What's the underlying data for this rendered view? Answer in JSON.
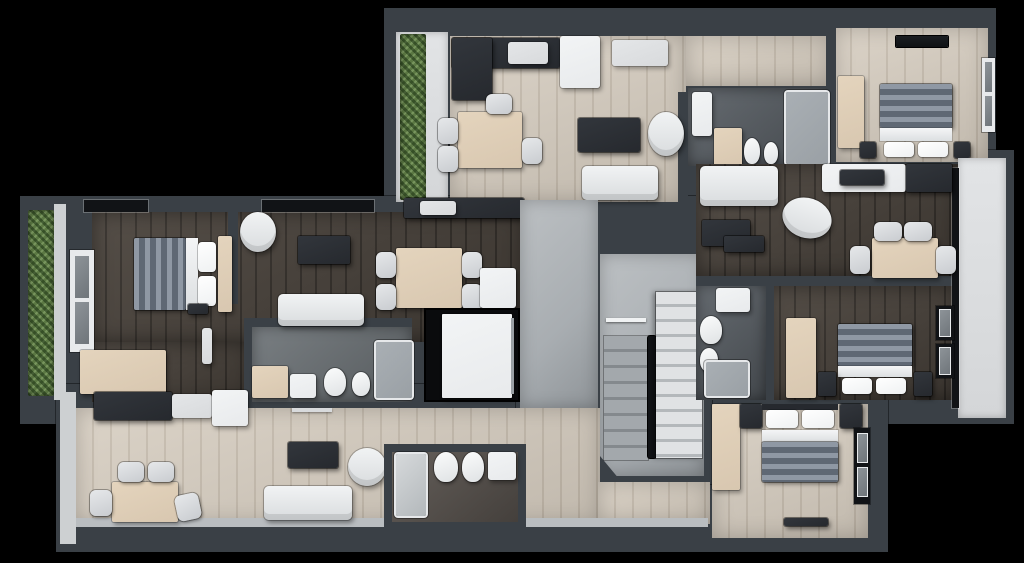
{
  "render": {
    "width": 1024,
    "height": 563,
    "style": "3d-top-down-floor-plan",
    "background": "#000000"
  },
  "palette": {
    "bg": "#000000",
    "wall": "#3a4046",
    "wallInner": "#cdd0d2",
    "floorLight": "#d7cec1",
    "floorDark": "#4a433c",
    "tileGray": "#6e7478",
    "tileSlate": "#5a6066",
    "tileBrown": "#5b5550",
    "concrete": "#a8adb1",
    "concreteLight": "#bcc0c3",
    "stairWhite": "#e0e2e4",
    "stairGray": "#a3a8ac",
    "white": "#e8eaec",
    "offWhite": "#d8dadc",
    "furnDark": "#26292e",
    "furnBlack": "#111316",
    "woodF": "#d8c7b0",
    "hedge": "#5b7843",
    "glass": "#9aa0a5",
    "blanketL": "#8f98a4",
    "blanketD": "#5f6874",
    "pillow": "#eff1f2",
    "balcony": "#d4d6d8",
    "shaft": "#0a0b0d"
  },
  "core": {
    "corridor": {
      "floor": "concrete"
    },
    "elevator": {
      "parts": [
        "shaft",
        "cabin"
      ]
    },
    "staircase": {
      "flights": 2,
      "style": "u-shaped",
      "materials": [
        "white-steps",
        "concrete-steps"
      ]
    }
  },
  "apartments": [
    {
      "id": "top",
      "rooms": [
        {
          "name": "balcony",
          "floor": "white-deck",
          "features": [
            "hedge-planter"
          ]
        },
        {
          "name": "living-kitchen",
          "floor": "light-wood",
          "furniture": [
            "kitchen-counter",
            "sink",
            "fridge",
            "sideboard",
            "dining-table",
            "chairs-x4",
            "tv-stand",
            "armchair",
            "sofa"
          ]
        },
        {
          "name": "hallway",
          "floor": "light-wood",
          "furniture": []
        },
        {
          "name": "bathroom",
          "floor": "dark-tile",
          "furniture": [
            "washbasin-cabinet",
            "storage-cabinet",
            "toilet",
            "bidet",
            "walk-in-shower"
          ]
        },
        {
          "name": "bedroom",
          "floor": "light-wood",
          "features": [
            "window",
            "ceiling-vent"
          ],
          "furniture": [
            "wardrobe",
            "double-bed",
            "nightstand-x2"
          ]
        }
      ]
    },
    {
      "id": "left",
      "rooms": [
        {
          "name": "balcony",
          "floor": "white-deck",
          "features": [
            "hedge-planter"
          ]
        },
        {
          "name": "bedroom",
          "floor": "dark-wood",
          "features": [
            "window",
            "top-wall-windows"
          ],
          "furniture": [
            "double-bed",
            "headboard-wardrobe",
            "dresser",
            "wall-tv"
          ]
        },
        {
          "name": "living",
          "floor": "dark-wood",
          "furniture": [
            "armchair",
            "tv-bench",
            "sofa"
          ]
        },
        {
          "name": "kitchen-dining",
          "floor": "dark-wood",
          "furniture": [
            "kitchen-counter",
            "sink",
            "dining-table",
            "chairs-x4",
            "fridge"
          ]
        },
        {
          "name": "bathroom",
          "floor": "gray-tile",
          "furniture": [
            "vanity-cabinet",
            "washer",
            "toilet",
            "bidet",
            "walk-in-shower",
            "door-leaf"
          ]
        }
      ]
    },
    {
      "id": "right",
      "rooms": [
        {
          "name": "living-dining",
          "floor": "dark-wood",
          "furniture": [
            "sofa",
            "ottoman",
            "armchair",
            "tv-bench",
            "kitchen-counter",
            "sink",
            "dining-table",
            "chairs-x4"
          ]
        },
        {
          "name": "bathroom",
          "floor": "dark-tile",
          "furniture": [
            "washbasin",
            "toilet",
            "bidet",
            "shower"
          ]
        },
        {
          "name": "bedroom",
          "floor": "dark-wood",
          "features": [
            "windows-x2"
          ],
          "furniture": [
            "wardrobe",
            "double-bed",
            "nightstand-x2"
          ]
        },
        {
          "name": "balcony",
          "floor": "white-deck",
          "features": [
            "glazing"
          ]
        }
      ]
    },
    {
      "id": "bottom",
      "rooms": [
        {
          "name": "living-kitchen",
          "floor": "light-wood",
          "furniture": [
            "kitchen-counter",
            "sink",
            "fridge",
            "dining-table",
            "chairs-x4",
            "tv-stand",
            "armchair",
            "sofa",
            "towel-rail"
          ]
        },
        {
          "name": "bathroom",
          "floor": "brown-tile",
          "furniture": [
            "walk-in-shower",
            "toilet",
            "bidet",
            "vanity-washbasin"
          ]
        },
        {
          "name": "corridor",
          "floor": "light-wood",
          "furniture": []
        },
        {
          "name": "bedroom",
          "floor": "light-wood",
          "features": [
            "window",
            "door-threshold"
          ],
          "furniture": [
            "wardrobe",
            "double-bed",
            "nightstand-x2"
          ]
        }
      ]
    }
  ]
}
